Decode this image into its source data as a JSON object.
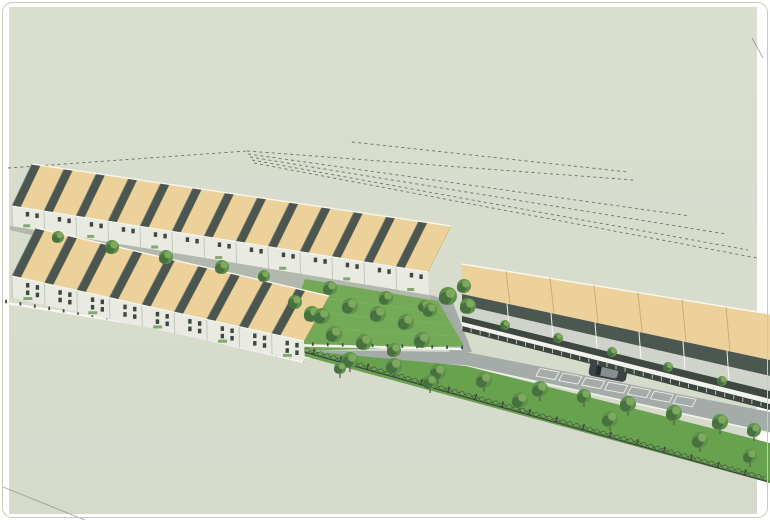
{
  "meta": {
    "description": "3D aerial architectural rendering of a terraced housing development with two rows of tan-roof terrace houses, a shophouse row, access road with parked car, tree-lined lawn and dashed survey boundary lines on a pale sage canvas",
    "width": 770,
    "height": 520
  },
  "palette": {
    "canvas": "#d8dcce",
    "frame": "#ffffff",
    "frameLine": "#c6cabf",
    "dash": "#6b7165",
    "stray": "#8a9088",
    "roofTan": "#ecd29a",
    "roofTanEdge": "#c8a86d",
    "ridgeWhite": "#f7f8f3",
    "gable": "#4c5651",
    "gableLight": "#707a74",
    "wall": "#e9ebe3",
    "wallShade": "#c2c7bd",
    "window": "#3d4743",
    "street": "#b3b8ae",
    "road": "#a5aba8",
    "kerb": "#f1f3ec",
    "lawn": "#68a24e",
    "park": "#74aa57",
    "treeDark": "#41693c",
    "treeMid": "#5f914c",
    "treeLight": "#83ad5f",
    "trunk": "#5d5647",
    "fence": "#3c453f",
    "wallWhite": "#f5f6f0",
    "post": "#434c46",
    "car": "#3c4245",
    "carGlass": "#23292c",
    "carLight": "#868e90",
    "stall": "#eef0ea",
    "rear": "#4d5752",
    "court": "#cfd3cb",
    "awning": "#3f4743"
  },
  "frame": {
    "canvas_rect": [
      9,
      7,
      748,
      507
    ],
    "outline_inset": 2.5,
    "outline_radius": 10
  },
  "dashed_lines": [
    [
      8,
      168,
      247,
      151
    ],
    [
      247,
      151,
      633,
      180
    ],
    [
      248,
      154,
      690,
      216
    ],
    [
      250,
      157,
      726,
      234
    ],
    [
      252,
      160,
      748,
      250
    ],
    [
      254,
      163,
      757,
      258
    ],
    [
      352,
      142,
      628,
      172
    ]
  ],
  "stray_lines": [
    [
      3,
      487,
      85,
      520
    ],
    [
      752,
      38,
      763,
      58
    ]
  ],
  "terrace_rows": [
    {
      "id": "terrace-row-upper",
      "ridge": [
        [
          10,
          164
        ],
        [
          426,
          226
        ]
      ],
      "roof_h": [
        42,
        46
      ],
      "skew": [
        22,
        25
      ],
      "units": 13,
      "gable_frac": 0.27,
      "facade_h": [
        20,
        23
      ],
      "window_rows": 1
    },
    {
      "id": "terrace-row-middle",
      "ridge": [
        [
          10,
          228
        ],
        [
          302,
          296
        ]
      ],
      "roof_h": [
        48,
        45
      ],
      "skew": [
        26,
        27
      ],
      "units": 9,
      "gable_frac": 0.27,
      "facade_h": [
        22,
        21
      ],
      "window_rows": 2
    }
  ],
  "street_poly": [
    [
      10,
      226
    ],
    [
      436,
      296
    ],
    [
      444,
      312
    ],
    [
      302,
      298
    ],
    [
      10,
      230
    ]
  ],
  "connector_poly": [
    [
      430,
      296
    ],
    [
      452,
      300
    ],
    [
      472,
      352
    ],
    [
      450,
      353
    ]
  ],
  "road_poly": [
    [
      298,
      350
    ],
    [
      466,
      352
    ],
    [
      770,
      412
    ],
    [
      770,
      433
    ],
    [
      466,
      366
    ],
    [
      298,
      357
    ]
  ],
  "road_kerb": [
    [
      298,
      357
    ],
    [
      466,
      366
    ],
    [
      770,
      433
    ]
  ],
  "lawn_poly": [
    [
      286,
      349
    ],
    [
      466,
      366
    ],
    [
      770,
      443
    ],
    [
      770,
      483
    ],
    [
      289,
      352
    ]
  ],
  "park_poly": [
    [
      305,
      279
    ],
    [
      438,
      301
    ],
    [
      464,
      346
    ],
    [
      300,
      351
    ],
    [
      281,
      344
    ]
  ],
  "park_wall": [
    [
      283,
      345
    ],
    [
      462,
      349
    ]
  ],
  "row2_wall": [
    [
      6,
      303
    ],
    [
      150,
      326
    ],
    [
      304,
      362
    ]
  ],
  "gate_quads": [
    [
      [
        256,
        336
      ],
      [
        274,
        340
      ],
      [
        274,
        350
      ],
      [
        256,
        346
      ]
    ],
    [
      [
        276,
        342
      ],
      [
        294,
        346
      ],
      [
        294,
        351
      ],
      [
        276,
        347
      ]
    ]
  ],
  "shophouse_row": {
    "id": "shophouse-row",
    "top": [
      [
        462,
        264
      ],
      [
        770,
        314
      ]
    ],
    "units": 7,
    "bands": [
      {
        "name": "tan-roof",
        "h": [
          30,
          46
        ],
        "color": "roofTan"
      },
      {
        "name": "rear-extension",
        "h": [
          11,
          16
        ],
        "color": "rear"
      },
      {
        "name": "courtyard",
        "h": [
          11,
          15
        ],
        "color": "court"
      },
      {
        "name": "awning",
        "h": [
          6,
          8
        ],
        "color": "awning"
      },
      {
        "name": "walkway",
        "h": [
          4,
          5
        ],
        "color": "kerb"
      },
      {
        "name": "front-fence",
        "h": [
          5,
          6
        ],
        "color": "fence"
      }
    ]
  },
  "parking_stalls": {
    "x0": 540,
    "x1": 700,
    "count": 7,
    "line": [
      [
        466,
        353
      ],
      [
        770,
        413
      ]
    ]
  },
  "car": {
    "cx": 608,
    "cy": 372,
    "angle": 11,
    "len": 38,
    "wid": 14
  },
  "lawn_fence": [
    [
      286,
      347
    ],
    [
      769,
      482
    ]
  ],
  "trees": {
    "street": [
      [
        58,
        237,
        6
      ],
      [
        112,
        247,
        7
      ],
      [
        166,
        257,
        7
      ],
      [
        222,
        267,
        7
      ],
      [
        264,
        276,
        6
      ],
      [
        330,
        288,
        7
      ],
      [
        386,
        298,
        7
      ],
      [
        424,
        306,
        6
      ]
    ],
    "row_ends": [
      [
        448,
        296,
        9
      ],
      [
        464,
        286,
        7
      ],
      [
        468,
        306,
        8
      ],
      [
        295,
        302,
        7
      ],
      [
        312,
        314,
        8
      ]
    ],
    "park": [
      [
        322,
        316,
        8
      ],
      [
        350,
        306,
        8
      ],
      [
        378,
        314,
        8
      ],
      [
        406,
        322,
        8
      ],
      [
        334,
        334,
        8
      ],
      [
        364,
        342,
        8
      ],
      [
        394,
        350,
        7
      ],
      [
        422,
        340,
        8
      ],
      [
        430,
        310,
        7
      ]
    ],
    "courtyard": [
      [
        505,
        325,
        5
      ],
      [
        558,
        338,
        5
      ],
      [
        612,
        352,
        5
      ],
      [
        668,
        367,
        5
      ],
      [
        722,
        381,
        5
      ]
    ],
    "verge": [
      [
        350,
        360,
        8
      ],
      [
        394,
        366,
        8
      ],
      [
        438,
        372,
        8
      ],
      [
        484,
        380,
        8
      ],
      [
        540,
        389,
        8
      ],
      [
        584,
        396,
        7
      ],
      [
        628,
        404,
        8
      ],
      [
        674,
        413,
        8
      ],
      [
        720,
        422,
        8
      ],
      [
        754,
        430,
        7
      ]
    ],
    "lawn": [
      [
        340,
        368,
        6
      ],
      [
        430,
        382,
        7
      ],
      [
        520,
        400,
        8
      ],
      [
        610,
        419,
        8
      ],
      [
        700,
        440,
        8
      ],
      [
        750,
        456,
        7
      ]
    ]
  }
}
